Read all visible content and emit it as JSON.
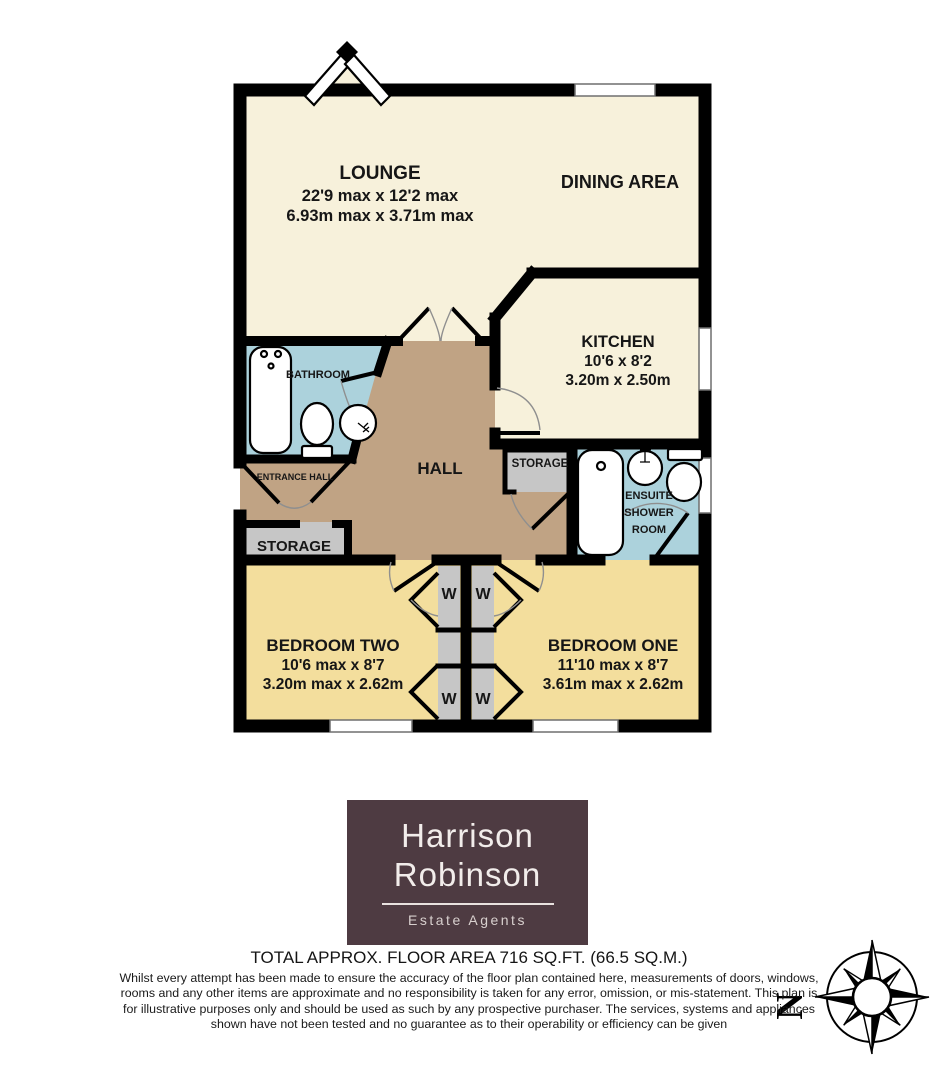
{
  "plan": {
    "rooms": {
      "lounge": {
        "name": "LOUNGE",
        "dims_imperial": "22'9 max x 12'2 max",
        "dims_metric": "6.93m max x 3.71m max"
      },
      "dining_area": {
        "name": "DINING AREA"
      },
      "kitchen": {
        "name": "KITCHEN",
        "dims_imperial": "10'6 x 8'2",
        "dims_metric": "3.20m x 2.50m"
      },
      "bathroom": {
        "name": "BATHROOM"
      },
      "hall": {
        "name": "HALL"
      },
      "entrance_hall": {
        "name": "ENTRANCE HALL"
      },
      "storage_entrance": {
        "name": "STORAGE"
      },
      "storage_hall": {
        "name": "STORAGE"
      },
      "ensuite": {
        "name_line1": "ENSUITE",
        "name_line2": "SHOWER",
        "name_line3": "ROOM"
      },
      "bedroom_two": {
        "name": "BEDROOM TWO",
        "dims_imperial": "10'6 max x 8'7",
        "dims_metric": "3.20m max x 2.62m"
      },
      "bedroom_one": {
        "name": "BEDROOM ONE",
        "dims_imperial": "11'10 max x 8'7",
        "dims_metric": "3.61m max x 2.62m"
      }
    },
    "wardrobe_label": "W",
    "compass_north": "N",
    "colors": {
      "floor_cream": "#F7F1DB",
      "floor_yellow": "#F3DE9D",
      "floor_blue": "#ACD2DC",
      "floor_tan": "#C0A384",
      "storage_gray": "#C6C6C6",
      "wall_black": "#000000",
      "logo_background": "#4E3B42",
      "logo_text": "#F2EDEB"
    }
  },
  "logo": {
    "name_line1": "Harrison",
    "name_line2": "Robinson",
    "tagline": "Estate Agents"
  },
  "footer": {
    "total_area": "TOTAL APPROX. FLOOR AREA 716 SQ.FT. (66.5 SQ.M.)",
    "disclaimer": "Whilst every attempt has been made to ensure the accuracy of the floor plan contained here, measurements of doors, windows, rooms and any other items are approximate and no responsibility is taken for any error, omission, or mis-statement. This plan is for illustrative purposes only and should be used as such by any prospective purchaser. The services, systems and appliances shown have not been tested and no guarantee as to their operability or efficiency can be given"
  }
}
